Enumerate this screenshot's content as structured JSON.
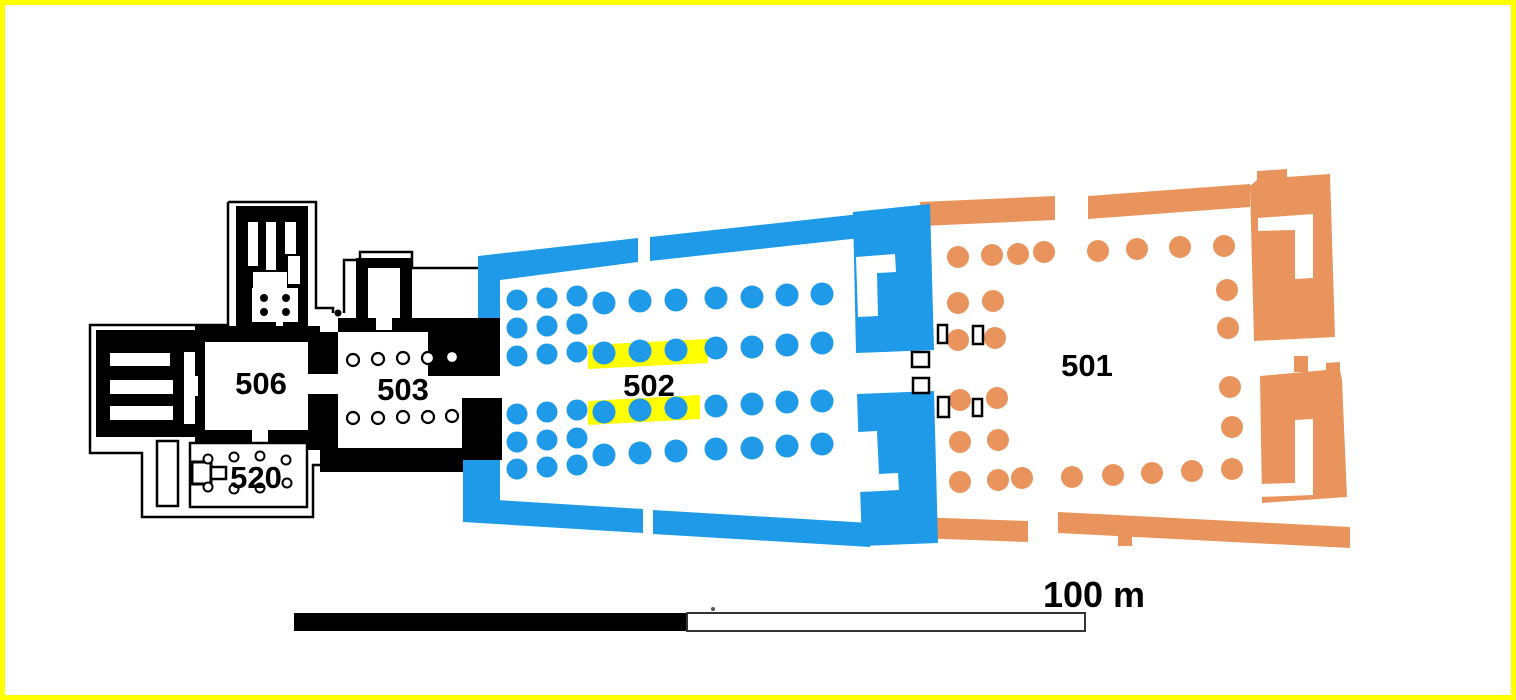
{
  "colors": {
    "yellow": "#FFFF00",
    "blue": "#1E9AE9",
    "orange": "#E8945C",
    "black": "#000000",
    "white": "#FFFFFF",
    "scale_outline": "#333333"
  },
  "plan": {
    "labels": {
      "area501": "501",
      "area502": "502",
      "area503": "503",
      "area506": "506",
      "area520": "520"
    },
    "column_groups": [
      {
        "name": "hypostyle-cluster-columns",
        "fill": "blue",
        "r": 10.5,
        "points": [
          [
            517,
            300
          ],
          [
            547,
            298
          ],
          [
            577,
            296
          ],
          [
            517,
            328
          ],
          [
            547,
            326
          ],
          [
            577,
            324
          ],
          [
            517,
            356
          ],
          [
            547,
            354
          ],
          [
            577,
            352
          ],
          [
            517,
            414
          ],
          [
            547,
            412
          ],
          [
            577,
            410
          ],
          [
            517,
            442
          ],
          [
            547,
            440
          ],
          [
            577,
            438
          ],
          [
            517,
            469
          ],
          [
            547,
            467
          ],
          [
            577,
            465
          ]
        ]
      },
      {
        "name": "hypostyle-large-columns",
        "fill": "blue",
        "r": 11.5,
        "points": [
          [
            604,
            303
          ],
          [
            640,
            301
          ],
          [
            676,
            300
          ],
          [
            716,
            298
          ],
          [
            752,
            297
          ],
          [
            787,
            295
          ],
          [
            822,
            294
          ],
          [
            604,
            353
          ],
          [
            640,
            351
          ],
          [
            676,
            350
          ],
          [
            716,
            348
          ],
          [
            752,
            347
          ],
          [
            787,
            345
          ],
          [
            822,
            343
          ],
          [
            604,
            412
          ],
          [
            640,
            410
          ],
          [
            676,
            408
          ],
          [
            716,
            406
          ],
          [
            752,
            404
          ],
          [
            787,
            402
          ],
          [
            822,
            401
          ],
          [
            604,
            455
          ],
          [
            640,
            453
          ],
          [
            676,
            451
          ],
          [
            716,
            449
          ],
          [
            752,
            448
          ],
          [
            787,
            446
          ],
          [
            822,
            444
          ]
        ]
      },
      {
        "name": "court-columns",
        "fill": "orange",
        "r": 11,
        "points": [
          [
            958,
            257
          ],
          [
            992,
            255
          ],
          [
            1018,
            254
          ],
          [
            1044,
            252
          ],
          [
            1098,
            251
          ],
          [
            1137,
            249
          ],
          [
            1180,
            247
          ],
          [
            1224,
            246
          ],
          [
            958,
            303
          ],
          [
            993,
            301
          ],
          [
            958,
            340
          ],
          [
            995,
            338
          ],
          [
            960,
            400
          ],
          [
            997,
            398
          ],
          [
            960,
            442
          ],
          [
            998,
            440
          ],
          [
            1227,
            290
          ],
          [
            1228,
            328
          ],
          [
            1230,
            387
          ],
          [
            1232,
            427
          ],
          [
            960,
            482
          ],
          [
            998,
            480
          ],
          [
            1022,
            478
          ],
          [
            1072,
            477
          ],
          [
            1113,
            475
          ],
          [
            1152,
            473
          ],
          [
            1192,
            471
          ],
          [
            1232,
            469
          ]
        ]
      },
      {
        "name": "room503-columns",
        "fill": "white",
        "stroke": "black",
        "stroke_width": 2.2,
        "r": 6,
        "points": [
          [
            353,
            360
          ],
          [
            378,
            359
          ],
          [
            403,
            358
          ],
          [
            428,
            358
          ],
          [
            452,
            357
          ],
          [
            353,
            418
          ],
          [
            378,
            418
          ],
          [
            403,
            417
          ],
          [
            428,
            417
          ],
          [
            452,
            416
          ]
        ]
      },
      {
        "name": "room520-column-bases",
        "fill": "white",
        "stroke": "black",
        "stroke_width": 2,
        "r": 4.5,
        "points": [
          [
            208,
            459
          ],
          [
            234,
            457
          ],
          [
            260,
            456
          ],
          [
            286,
            460
          ],
          [
            208,
            487
          ],
          [
            234,
            489
          ],
          [
            260,
            488
          ],
          [
            287,
            483
          ]
        ]
      },
      {
        "name": "chapel-columns",
        "fill": "black",
        "r": 4,
        "points": [
          [
            264,
            298
          ],
          [
            286,
            298
          ],
          [
            264,
            312
          ],
          [
            286,
            312
          ]
        ]
      }
    ]
  },
  "scale_bar": {
    "label": "100 m"
  }
}
